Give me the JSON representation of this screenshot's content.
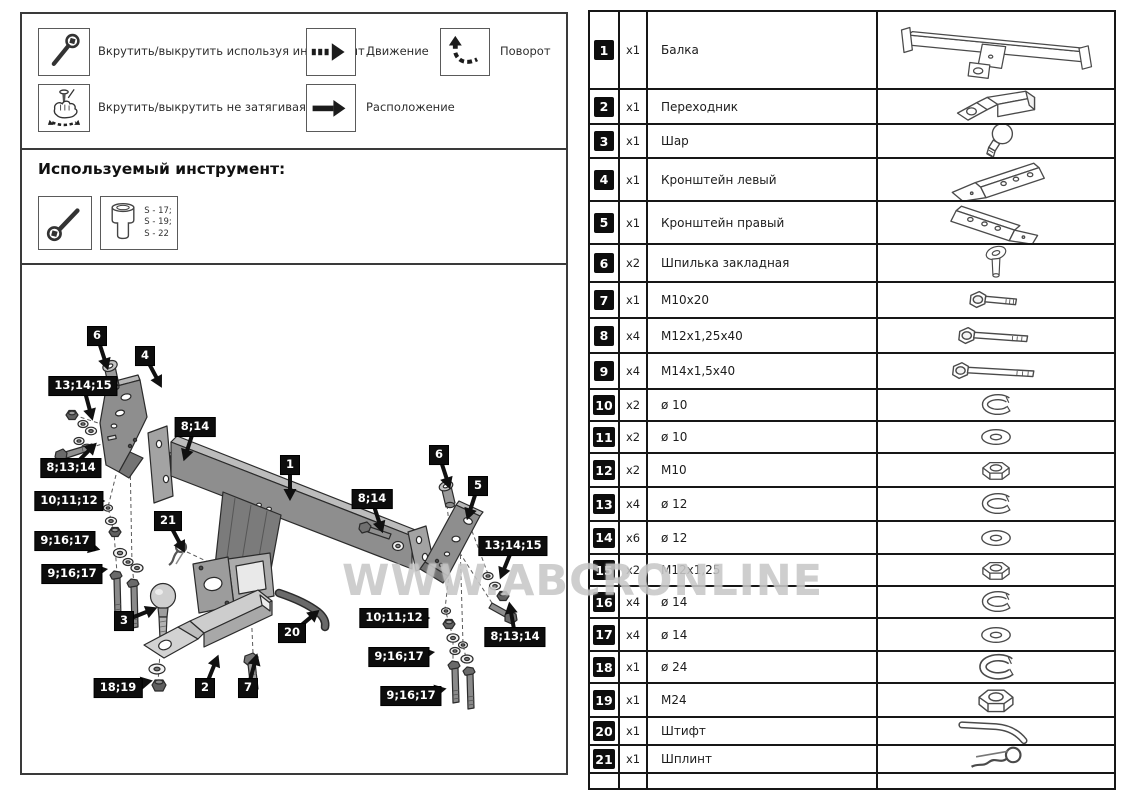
{
  "legend": {
    "items": [
      {
        "icon": "wrench-tool-icon",
        "label": "Вкрутить/выкрутить используя инструмент"
      },
      {
        "icon": "hand-tighten-icon",
        "label": "Вкрутить/выкрутить не затягивая"
      },
      {
        "icon": "dashed-arrow-icon",
        "label": "Движение"
      },
      {
        "icon": "solid-arrow-icon",
        "label": "Расположение"
      },
      {
        "icon": "rotate-arrow-icon",
        "label": "Поворот"
      }
    ]
  },
  "tools": {
    "title": "Используемый инструмент:",
    "icons": [
      "ratchet-wrench-icon",
      "socket-icon"
    ],
    "socket_sizes": [
      "S - 17;",
      "S - 19;",
      "S - 22"
    ]
  },
  "watermark": "WWW.ABCRONLINE",
  "diagram": {
    "callouts": [
      {
        "label": "6",
        "x": 75,
        "y": 71,
        "angle": 72
      },
      {
        "label": "4",
        "x": 123,
        "y": 91,
        "angle": 62
      },
      {
        "label": "13;14;15",
        "x": 61,
        "y": 121,
        "angle": 75
      },
      {
        "label": "8;14",
        "x": 173,
        "y": 162,
        "angle": 108
      },
      {
        "label": "8;13;14",
        "x": 49,
        "y": 203,
        "angle": -45
      },
      {
        "label": "10;11;12",
        "x": 47,
        "y": 236,
        "angle": 0
      },
      {
        "label": "1",
        "x": 268,
        "y": 200,
        "angle": 90
      },
      {
        "label": "8;14",
        "x": 350,
        "y": 234,
        "angle": 72
      },
      {
        "label": "21",
        "x": 146,
        "y": 256,
        "angle": 62
      },
      {
        "label": "9;16;17",
        "x": 43,
        "y": 276,
        "angle": 14
      },
      {
        "label": "9;16;17",
        "x": 50,
        "y": 309,
        "angle": -8
      },
      {
        "label": "6",
        "x": 417,
        "y": 190,
        "angle": 72
      },
      {
        "label": "5",
        "x": 456,
        "y": 221,
        "angle": 108
      },
      {
        "label": "13;14;15",
        "x": 491,
        "y": 281,
        "angle": 112
      },
      {
        "label": "10;11;12",
        "x": 372,
        "y": 353,
        "angle": 0
      },
      {
        "label": "8;13;14",
        "x": 493,
        "y": 372,
        "angle": -100
      },
      {
        "label": "3",
        "x": 102,
        "y": 356,
        "angle": -22
      },
      {
        "label": "20",
        "x": 270,
        "y": 368,
        "angle": -40
      },
      {
        "label": "9;16;17",
        "x": 377,
        "y": 392,
        "angle": -8
      },
      {
        "label": "18;19",
        "x": 96,
        "y": 423,
        "angle": -12
      },
      {
        "label": "2",
        "x": 183,
        "y": 423,
        "angle": -68
      },
      {
        "label": "7",
        "x": 226,
        "y": 423,
        "angle": -75
      },
      {
        "label": "9;16;17",
        "x": 389,
        "y": 431,
        "angle": -12
      }
    ]
  },
  "parts": {
    "rows": [
      {
        "num": "1",
        "qty": "x1",
        "name": "Балка",
        "icon": "beam"
      },
      {
        "num": "2",
        "qty": "x1",
        "name": "Переходник",
        "icon": "adapter"
      },
      {
        "num": "3",
        "qty": "x1",
        "name": "Шар",
        "icon": "ball"
      },
      {
        "num": "4",
        "qty": "x1",
        "name": "Кронштейн левый",
        "icon": "bracket-left"
      },
      {
        "num": "5",
        "qty": "x1",
        "name": "Кронштейн правый",
        "icon": "bracket-right"
      },
      {
        "num": "6",
        "qty": "x2",
        "name": "Шпилька закладная",
        "icon": "stud"
      },
      {
        "num": "7",
        "qty": "x1",
        "name": "M10x20",
        "icon": "bolt-short"
      },
      {
        "num": "8",
        "qty": "x4",
        "name": "M12x1,25x40",
        "icon": "bolt-medium"
      },
      {
        "num": "9",
        "qty": "x4",
        "name": "M14x1,5x40",
        "icon": "bolt-long"
      },
      {
        "num": "10",
        "qty": "x2",
        "name": "ø 10",
        "icon": "spring-washer"
      },
      {
        "num": "11",
        "qty": "x2",
        "name": "ø 10",
        "icon": "flat-washer"
      },
      {
        "num": "12",
        "qty": "x2",
        "name": "M10",
        "icon": "nut"
      },
      {
        "num": "13",
        "qty": "x4",
        "name": "ø 12",
        "icon": "spring-washer"
      },
      {
        "num": "14",
        "qty": "x6",
        "name": "ø 12",
        "icon": "flat-washer"
      },
      {
        "num": "15",
        "qty": "x2",
        "name": "M12x1,25",
        "icon": "nut"
      },
      {
        "num": "16",
        "qty": "x4",
        "name": "ø 14",
        "icon": "spring-washer"
      },
      {
        "num": "17",
        "qty": "x4",
        "name": "ø 14",
        "icon": "flat-washer"
      },
      {
        "num": "18",
        "qty": "x1",
        "name": "ø 24",
        "icon": "spring-washer-big"
      },
      {
        "num": "19",
        "qty": "x1",
        "name": "M24",
        "icon": "nut-big"
      },
      {
        "num": "20",
        "qty": "x1",
        "name": "Штифт",
        "icon": "pin"
      },
      {
        "num": "21",
        "qty": "x1",
        "name": "Шплинт",
        "icon": "cotter"
      }
    ]
  }
}
